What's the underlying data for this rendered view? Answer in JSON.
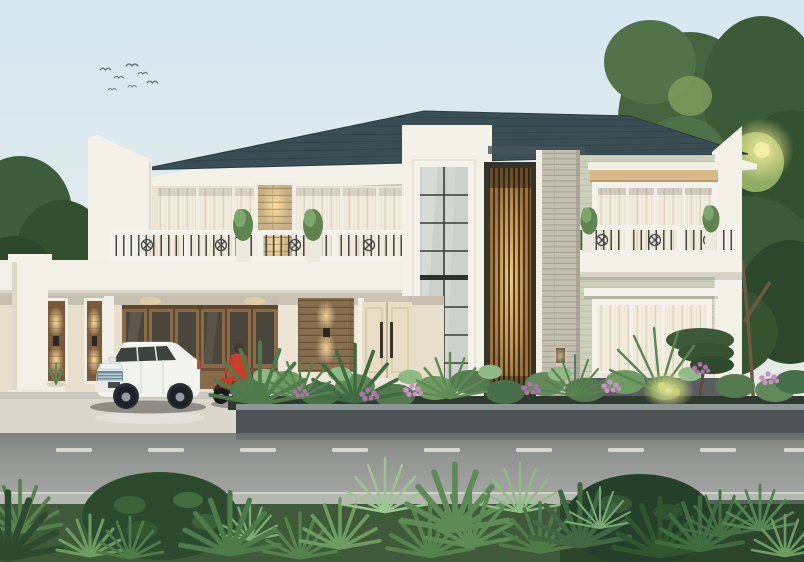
{
  "scene": {
    "type": "architectural-render",
    "description": "3D exterior rendering of a two-story modern classical house at dusk, viewed from the street",
    "objects": [
      "pale dusk sky",
      "flock of birds",
      "dark slate hip roof with white fascia",
      "white sloped parapet wall (left)",
      "upper balcony with wrought-iron railing and potted plants",
      "sheer curtained glass walls",
      "backlit stone accent panel",
      "two-story mullioned window tower",
      "backlit vertical wood slat feature",
      "stacked stone pillar",
      "sage green right wing with horizontal siding",
      "upper window with wood cornice and balcony",
      "ground floor window with white awning",
      "carport with white column and backlit stone niches",
      "wooden folding garage doors",
      "stacked stone entry wall with sconce",
      "cream double entry door with steps",
      "white SUV parked in carport",
      "red motorcycle with rider in red jacket",
      "concrete driveway",
      "planter garden with tropical plants and purple flowers",
      "dark planter curb",
      "asphalt road with dashed center line",
      "light sidewalk strip",
      "foreground shrubs, palms and ferns",
      "large trees on both sides with warm sun glow"
    ]
  },
  "palette": {
    "sky_top": "#d7e8f2",
    "sky_horizon": "#efe9da",
    "roof": "#3a4e54",
    "trim_white": "#f4f1e9",
    "wall_cream": "#ebe4d4",
    "wall_sage": "#cdd1bb",
    "stone_light": "#c4c0b1",
    "balcony_slab": "#f3f0e8",
    "carport_wall": "#e7decb",
    "garage_wood": "#8a6b47",
    "entry_stone": "#8a6e50",
    "door_cream": "#e9ddc6",
    "plinth": "#595d5f",
    "driveway": "#dad7cd",
    "curb": "#4d5355",
    "road": "#979a96",
    "road_line": "#eae9e1",
    "sidewalk": "#b6b9b2",
    "ground": "#3e5a38",
    "car_body": "#f3f3ef",
    "car_window": "#3c423e",
    "car_grille": "#6c8b97",
    "tire": "#1d2125",
    "rider_red": "#c8402c",
    "wood_slat": "#9a713c",
    "wood_glow": "#f4cd80",
    "glass": "#ccd2cb",
    "mullion": "#3a3c36",
    "railing_dark": "#474745",
    "curtain": "#f2ecdf",
    "leaf_dark": "#2c4a2e",
    "leaf_mid": "#55794f",
    "leaf_light": "#8fb987",
    "flower_purple": "#b272ab",
    "flower_pink": "#cf8fc6",
    "tree_green": "#3c5a38",
    "tree_light": "#9cb86a",
    "sun_glow": "#f3efa6"
  }
}
